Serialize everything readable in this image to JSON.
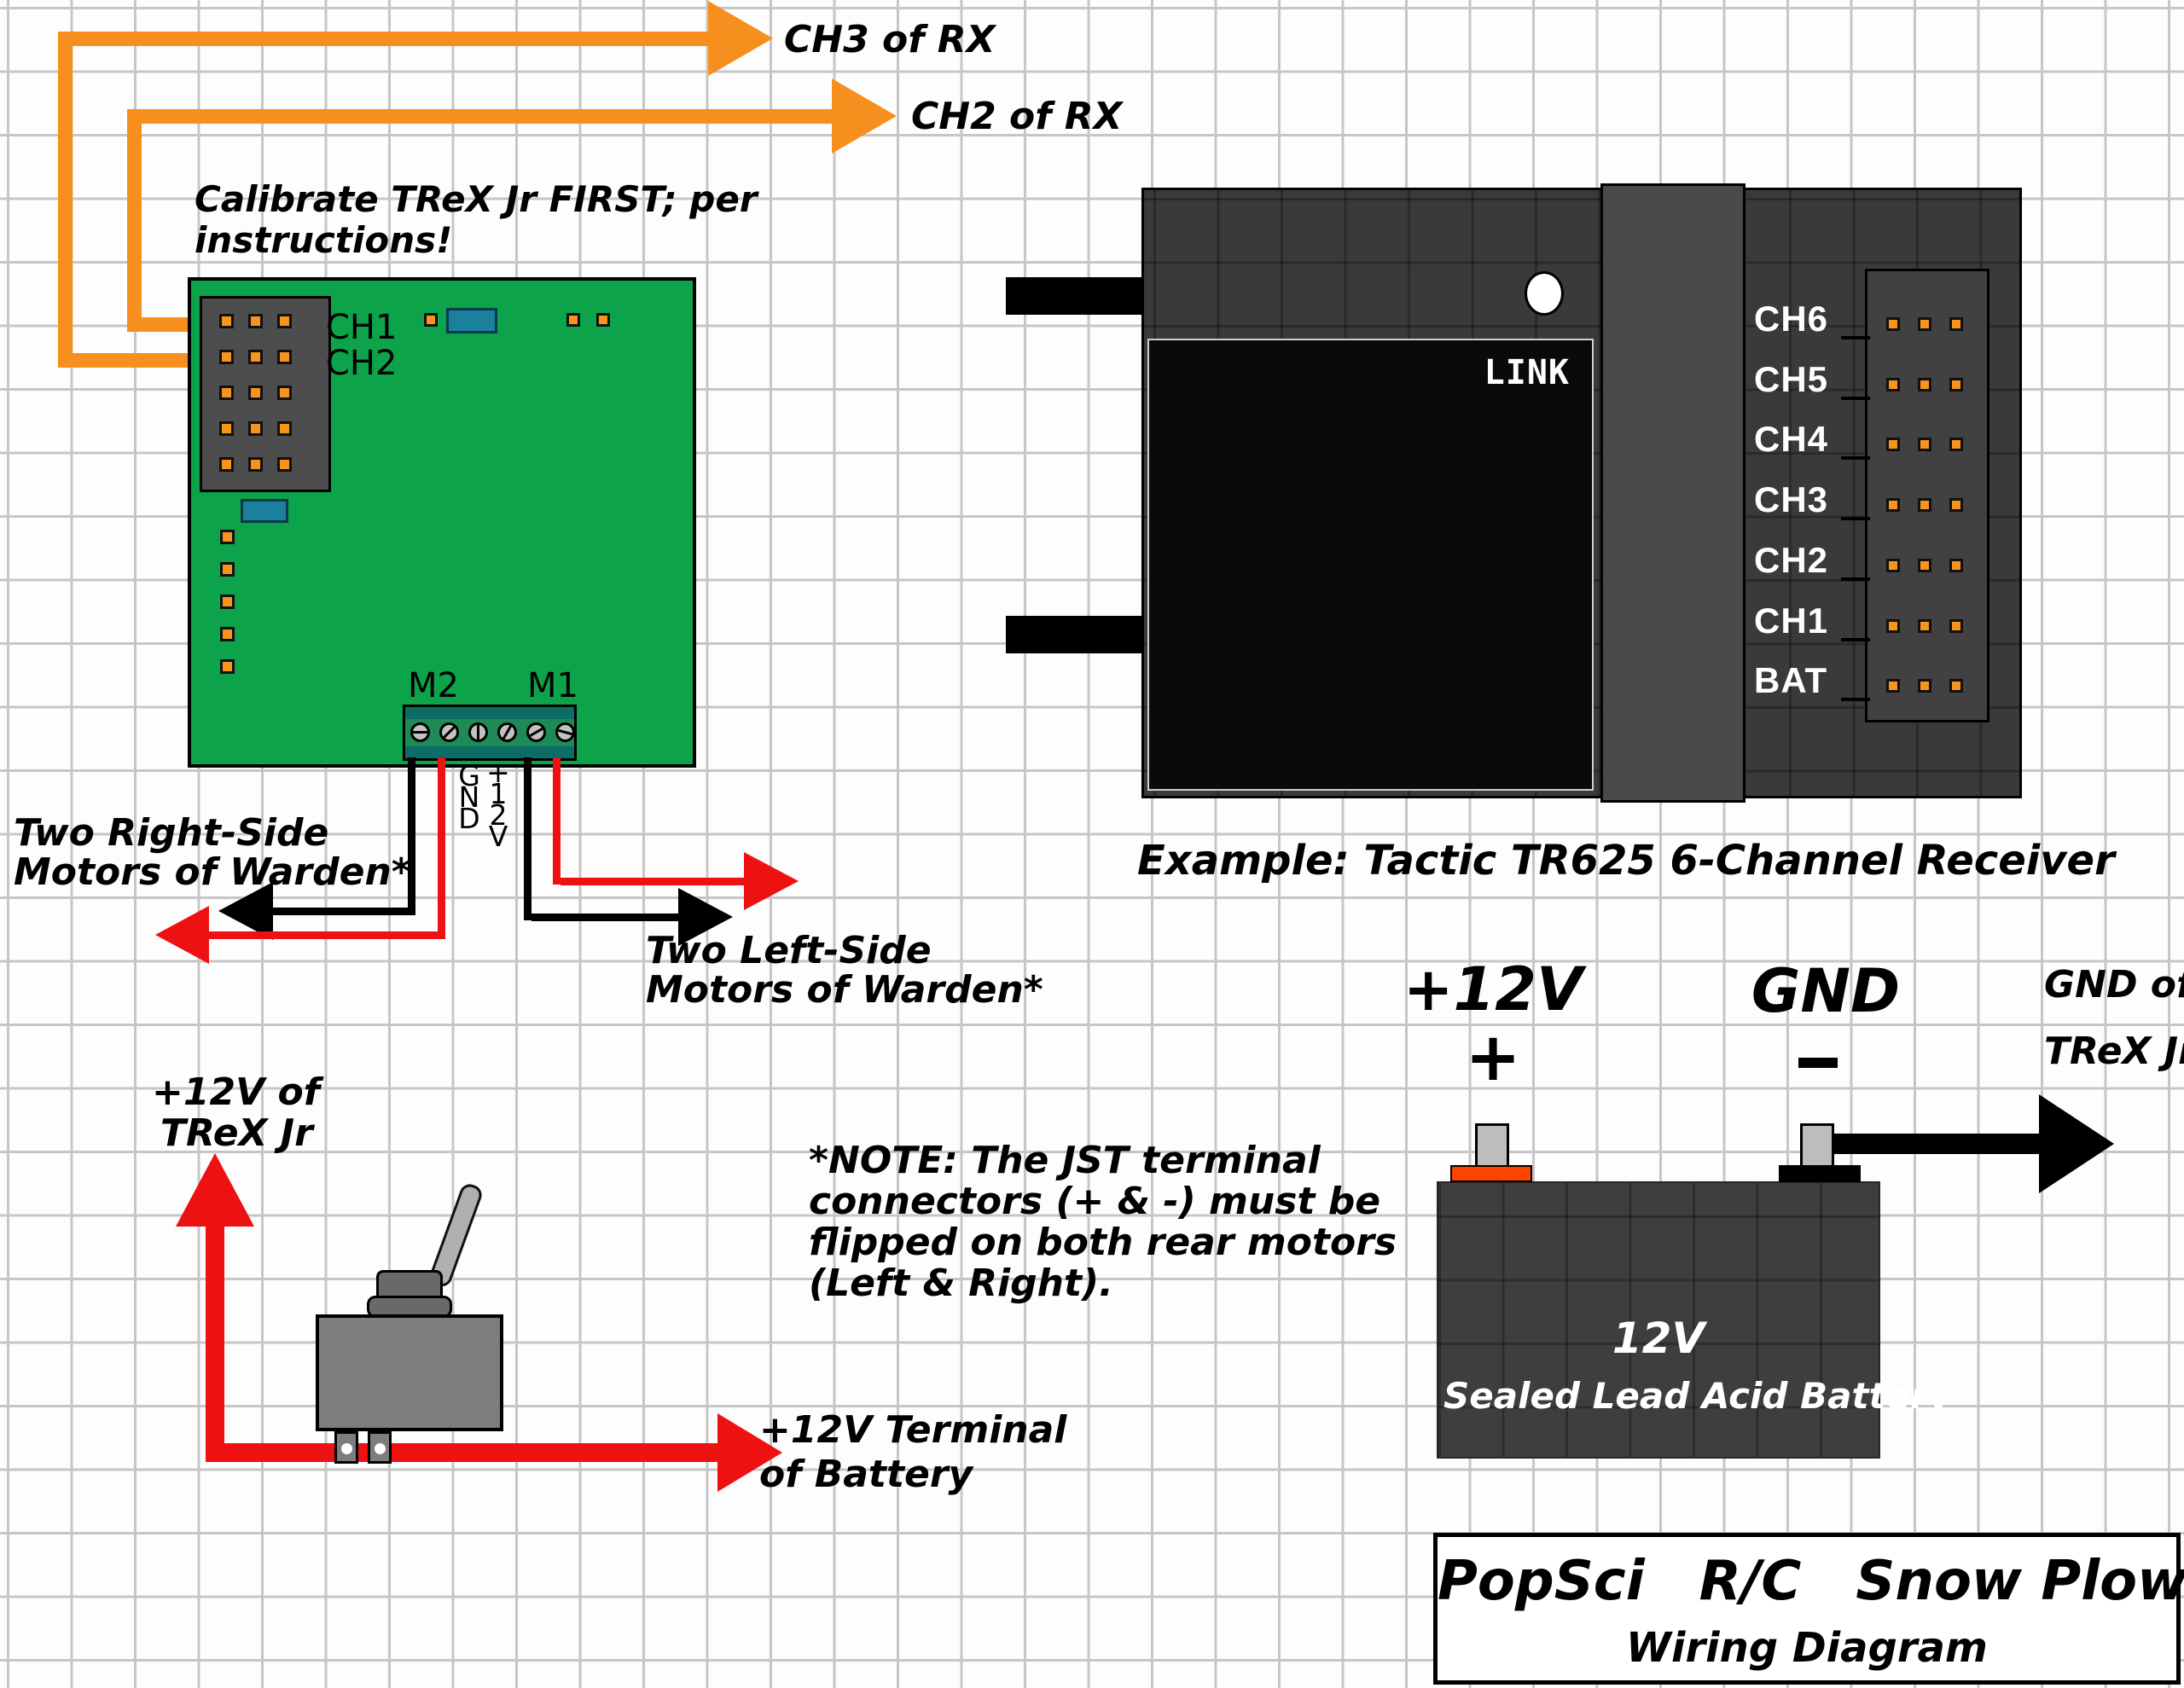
{
  "annotations": {
    "ch3_rx": "CH3 of RX",
    "ch2_rx": "CH2 of RX",
    "calibrate_line1": "Calibrate TReX Jr FIRST; per",
    "calibrate_line2": "instructions!"
  },
  "board": {
    "ch1": "CH1",
    "ch2": "CH2",
    "m2": "M2",
    "m1": "M1",
    "gnd_letters": [
      "G",
      "N",
      "D"
    ],
    "v12_letters": [
      "+",
      "1",
      "2",
      "V"
    ],
    "connector_rows": 5,
    "connector_cols": 3,
    "left_pin_count": 5,
    "screw_count": 6
  },
  "motors": {
    "right_line1": "Two Right-Side",
    "right_line2": "Motors of Warden*",
    "left_line1": "Two Left-Side",
    "left_line2": "Motors of Warden*"
  },
  "receiver": {
    "link": "LINK",
    "channels": [
      "CH6",
      "CH5",
      "CH4",
      "CH3",
      "CH2",
      "CH1",
      "BAT"
    ],
    "pins_per_channel": 3,
    "caption": "Example: Tactic TR625 6-Channel Receiver"
  },
  "battery": {
    "plus_label": "+12V",
    "plus_sign": "+",
    "gnd_label": "GND",
    "gnd_of_line1": "GND of",
    "gnd_of_line2": "TReX Jr",
    "body_line1": "12V",
    "body_line2": "Sealed Lead Acid Battery"
  },
  "switch_area": {
    "v12_line1": "+12V of",
    "v12_line2": "TReX Jr",
    "terminal_line1": "+12V Terminal",
    "terminal_line2": "of Battery"
  },
  "note": {
    "line1": "*NOTE: The JST terminal",
    "line2": "connectors (+ & -) must be",
    "line3": "flipped on both rear motors",
    "line4": "(Left & Right)."
  },
  "title": {
    "line1": "PopSci R/C Snow Plow",
    "line2": "Wiring Diagram"
  },
  "colors": {
    "wire_orange": "#F78F1E",
    "wire_red": "#EE1111",
    "wire_black": "#000000",
    "board_green": "#0DA34A",
    "component_teal": "#1B7F9E",
    "terminal_teal": "#0C6C66",
    "receiver_gray": "#3A3A3A",
    "panel_black": "#0A0A0A",
    "battery_gray": "#3E3E3E",
    "pin_orange": "#F7941D"
  }
}
